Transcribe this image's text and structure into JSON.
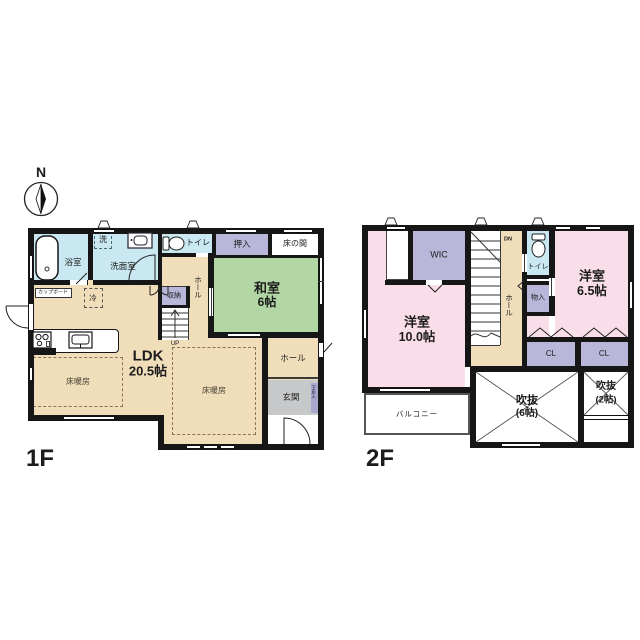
{
  "compass": {
    "north": "N"
  },
  "colors": {
    "wall": "#161616",
    "water_blue": "#c9e8f2",
    "tatami_green": "#b2d6a4",
    "wood_tan": "#f0ddba",
    "closet_purple": "#b9b7d9",
    "bedroom_pink": "#f9dde8",
    "entry_gray": "#c6c8c9",
    "shoebox_purple": "#aaa8cf"
  },
  "f1": {
    "floor_label": "1F",
    "bath": "浴室",
    "wash_room": "洗面室",
    "laundry": "洗",
    "toilet": "トイレ",
    "oshiire": "押入",
    "tokonoma": "床の間",
    "washitsu": "和室",
    "washitsu_size": "6帖",
    "hall_upper": "ホール",
    "storage": "収納",
    "cupboard": "カップボード",
    "fridge": "冷",
    "ldk": "LDK",
    "ldk_size": "20.5帖",
    "floor_heating": "床暖房",
    "hall_right": "ホール",
    "entrance": "玄関",
    "shoe_box": "下足入",
    "up": "UP"
  },
  "f2": {
    "floor_label": "2F",
    "wic": "WIC",
    "dn": "DN",
    "toilet": "トイレ",
    "storage": "物入",
    "hall": "ホール",
    "bedroom_large": "洋室",
    "bedroom_large_size": "10.0帖",
    "bedroom_small": "洋室",
    "bedroom_small_size": "6.5帖",
    "closet": "CL",
    "void_large": "吹抜",
    "void_large_size": "(6帖)",
    "void_small": "吹抜",
    "void_small_size": "(2帖)",
    "balcony": "バルコニー"
  }
}
